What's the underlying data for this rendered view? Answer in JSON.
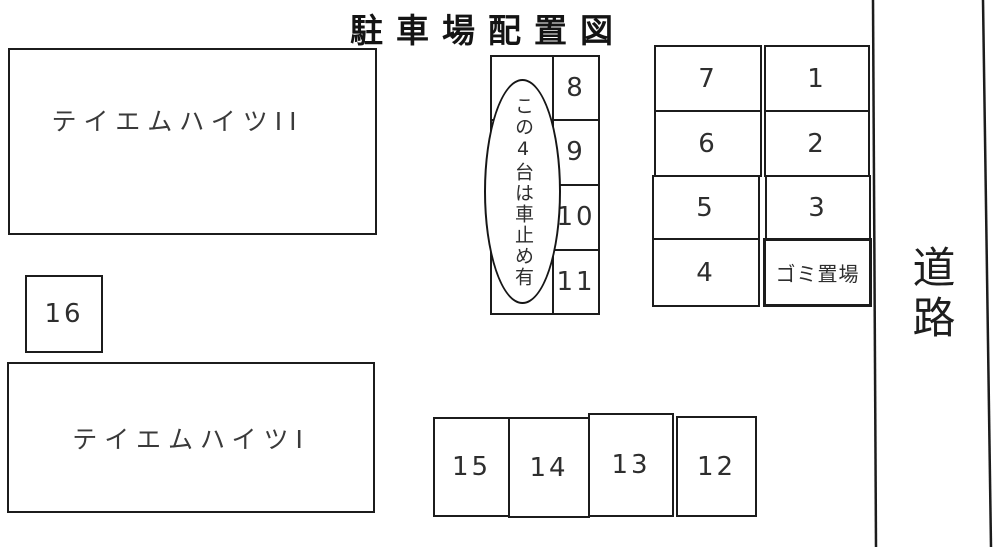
{
  "title": "駐車場配置図",
  "buildings": {
    "building_2": "テイエムハイツII",
    "building_1": "テイエムハイツI"
  },
  "center_block": {
    "spaces": [
      "8",
      "9",
      "10",
      "11"
    ],
    "note": "この4台は車止め有"
  },
  "right_block": {
    "left_column": [
      "7",
      "6",
      "5",
      "4"
    ],
    "right_column": [
      "1",
      "2",
      "3"
    ],
    "garbage_label": "ゴミ置場"
  },
  "bottom_row": [
    "15",
    "14",
    "13",
    "12"
  ],
  "standalone_space": "16",
  "road_label": "道路",
  "colors": {
    "line": "#1c1c1c",
    "background": "#ffffff"
  }
}
